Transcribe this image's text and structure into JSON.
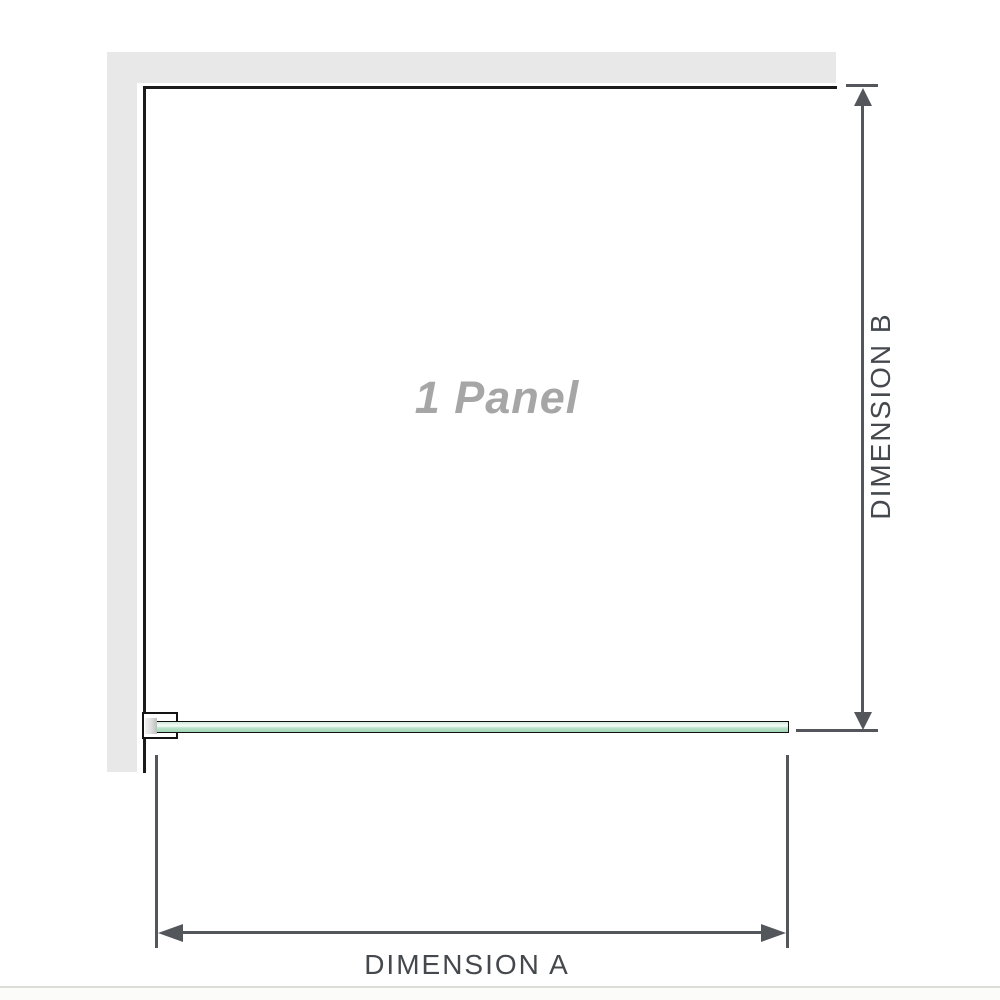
{
  "diagram": {
    "panel_label": "1 Panel",
    "dimension_a": {
      "label": "DIMENSION A",
      "orientation": "horizontal"
    },
    "dimension_b": {
      "label": "DIMENSION B",
      "orientation": "vertical"
    }
  },
  "icons": {
    "arrow_up_icon": "css-triangle-up",
    "arrow_down_icon": "css-triangle-down",
    "arrow_left_icon": "css-triangle-left",
    "arrow_right_icon": "css-triangle-right"
  },
  "colors": {
    "wall_gray": "#e8e8e8",
    "panel_outline": "#1b1b1b",
    "glass_green_top": "#cfe9d9",
    "glass_green_bottom": "#a0d5b6",
    "dimension_line": "#53575b",
    "dimension_text": "#45494d",
    "panel_text": "#a6a6a6",
    "footer_rule": "#dddcd8"
  }
}
